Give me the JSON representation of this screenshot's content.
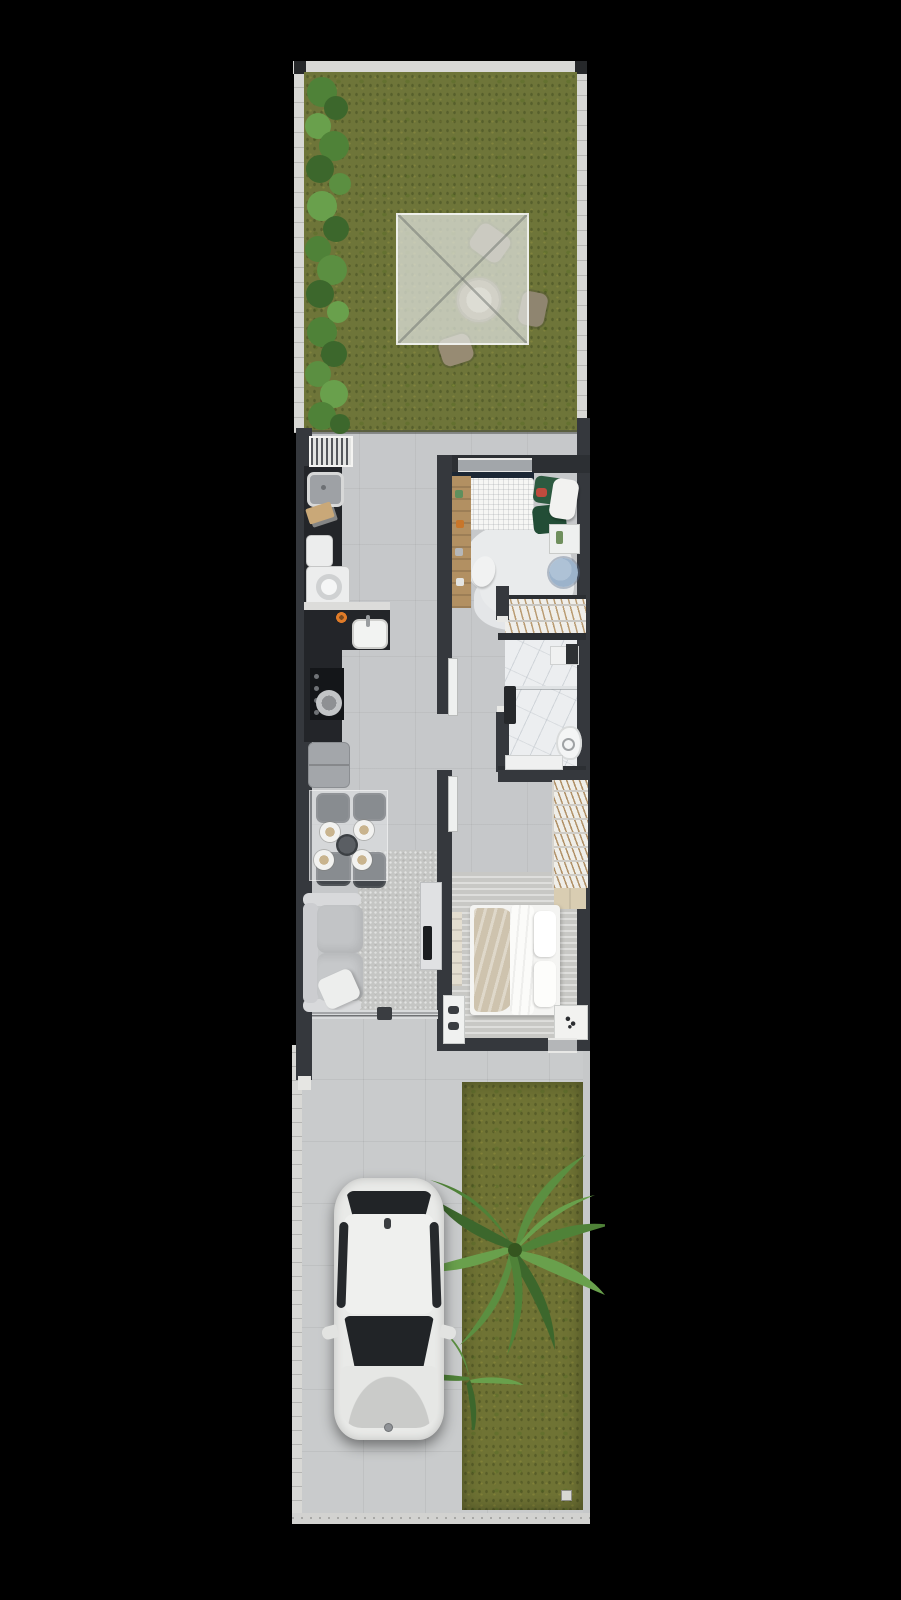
{
  "scene": {
    "kind": "architectural-floor-plan-render",
    "view": "top-down",
    "lot_shape": "narrow-vertical-strip",
    "sections_top_to_bottom": [
      "backyard",
      "house-interior",
      "driveway-and-front-garden"
    ]
  },
  "palette": {
    "background": "#000000",
    "lot_border": "#d8d8d5",
    "grass_back": "#6e7539",
    "grass_front": "#6f7334",
    "floor_interior": "#c6c8ca",
    "floor_drive": "#c9cbcc",
    "wall_dark": "#35383d",
    "wall_darker": "#2c2f33",
    "counter_black": "#232529",
    "white_goods": "#eceded",
    "fridge_gray": "#a3a6aa",
    "rug_light": "#c5c6c4",
    "marble": "#eceef0",
    "bed_white": "#f4f4f2",
    "blanket_beige": "#cec3ae",
    "green_sofa": "#2d5a40",
    "pouf_blue": "#9cb3cb",
    "wood": "#b29062",
    "wood_light": "#d9cdb2",
    "canopy": "rgba(226,229,224,0.72)",
    "chair_tan": "#8f8570",
    "car_body": "#e9eae8",
    "car_glass": "#212427",
    "leaf_dark": "#3c672c",
    "leaf_mid": "#4f8238",
    "leaf_light": "#69a04c"
  },
  "rooms": [
    "backyard-lawn",
    "service-patio",
    "laundry",
    "kitchen",
    "dining-area",
    "living-room",
    "hallway",
    "bedroom-1",
    "closet",
    "bathroom",
    "bedroom-2",
    "porch",
    "driveway",
    "front-garden"
  ],
  "objects": [
    "pergola-canopy",
    "outdoor-round-table",
    "outdoor-chairs",
    "garden-leaf-plants",
    "barbecue-grill",
    "laundry-sink",
    "washing-machine",
    "laundry-tank",
    "cutting-board",
    "kitchen-sink",
    "cooktop",
    "frying-pan",
    "refrigerator",
    "glass-dining-table",
    "dining-chairs",
    "place-settings",
    "center-bowl",
    "sofa",
    "throw-pillow",
    "living-rug",
    "tv-stand",
    "tv",
    "sliding-glass-door",
    "single-bed",
    "green-daybed",
    "study-desk",
    "stool",
    "blue-pouf",
    "side-tray",
    "hanging-closet",
    "shower-bench",
    "glass-shower-partition",
    "toilet",
    "vanity-shelf",
    "double-bed",
    "wardrobe",
    "dresser",
    "nightstand",
    "shoe-rack",
    "bedroom-rug",
    "white-car",
    "palm-tree",
    "lawn-drain-plate"
  ]
}
